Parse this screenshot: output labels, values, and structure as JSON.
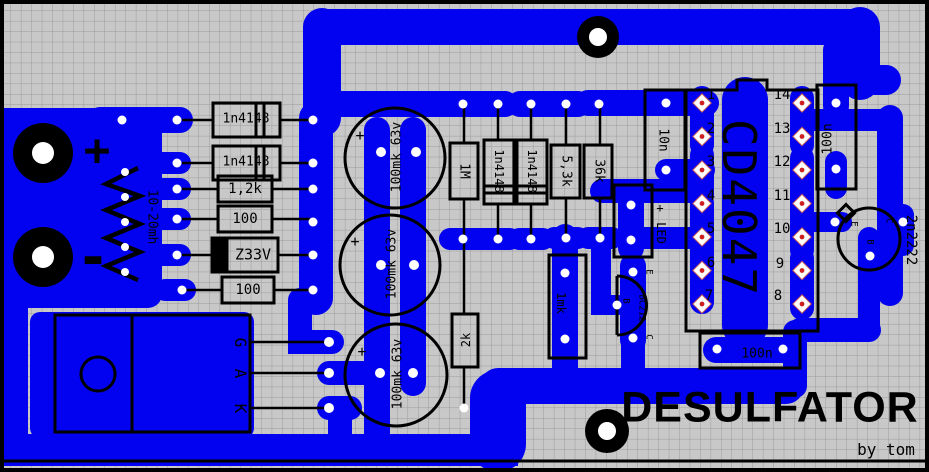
{
  "board": {
    "title": "DESULFATOR",
    "byline": "by tom",
    "plus": "+",
    "minus": "-",
    "colors": {
      "copper": "#0202f0",
      "board_bg": "#c8c8c8",
      "grid_line": "#9c9c9c",
      "silkscreen": "#000000",
      "hole": "#ffffff",
      "pin_marker": "#cc1f1f"
    }
  },
  "ic": {
    "name": "CD4047",
    "pins_left": [
      "1",
      "2",
      "3",
      "4",
      "5",
      "6",
      "7"
    ],
    "pins_right": [
      "14",
      "13",
      "12",
      "11",
      "10",
      "9",
      "8"
    ]
  },
  "components": {
    "l1": "10-20mh",
    "d1": "1n4148",
    "d2": "1n4148",
    "r1": "1,2k",
    "r2": "100",
    "dz": "Z33V",
    "r3": "100",
    "c1": "100mk 63v",
    "c2": "100mk 63v",
    "c3": "100mk 63v",
    "cap_plus": "+",
    "r4": "1M",
    "d3": "1n4148",
    "d4": "1n4148",
    "r5": "5,3k",
    "r6": "36k",
    "c4": "10n",
    "led": "LED",
    "led_plus": "+",
    "q1": "BC212",
    "q1_pins": [
      "E",
      "B",
      "C"
    ],
    "c5": "100n",
    "c6": "100n",
    "c7": "1mk",
    "r7": "2k",
    "q2": "2n2222",
    "q2_pins": [
      "E",
      "B",
      "C"
    ],
    "scr_pins": [
      "G",
      "A",
      "K"
    ]
  }
}
